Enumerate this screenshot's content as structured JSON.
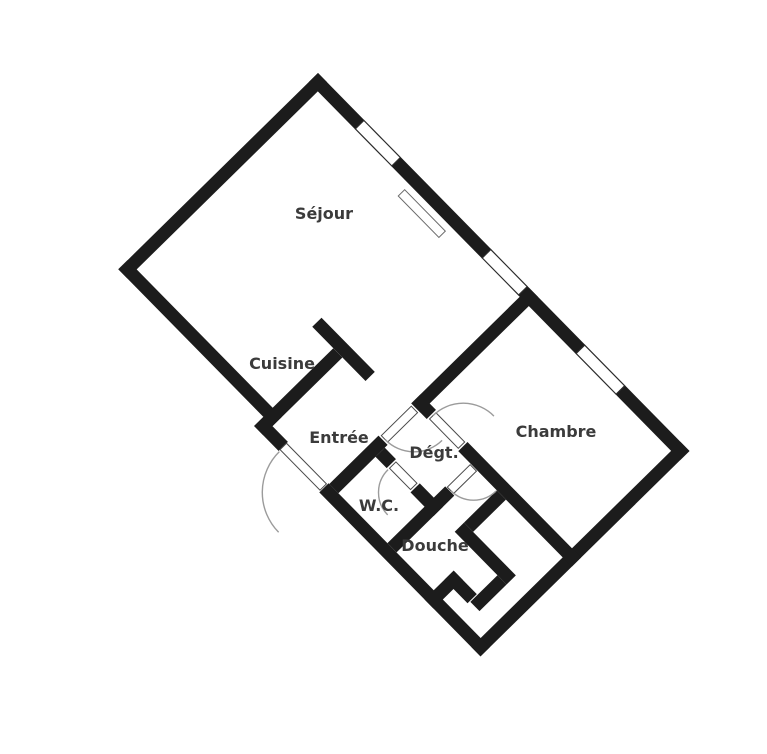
{
  "plan": {
    "title": "floor-plan",
    "rooms": [
      {
        "id": "sejour",
        "label": "Séjour"
      },
      {
        "id": "cuisine",
        "label": "Cuisine"
      },
      {
        "id": "entree",
        "label": "Entrée"
      },
      {
        "id": "degt",
        "label": "Dégt."
      },
      {
        "id": "chambre",
        "label": "Chambre"
      },
      {
        "id": "wc",
        "label": "W.C."
      },
      {
        "id": "douche",
        "label": "Douche"
      }
    ],
    "features": {
      "windows_count": 3,
      "doors_count": 5,
      "radiator_count": 1
    },
    "colors": {
      "wall": "#1c1c1c",
      "background": "#ffffff",
      "label_text": "#3b3b3b",
      "door_arc": "#9b9b9b",
      "window_outline": "#2b2b2b"
    }
  }
}
